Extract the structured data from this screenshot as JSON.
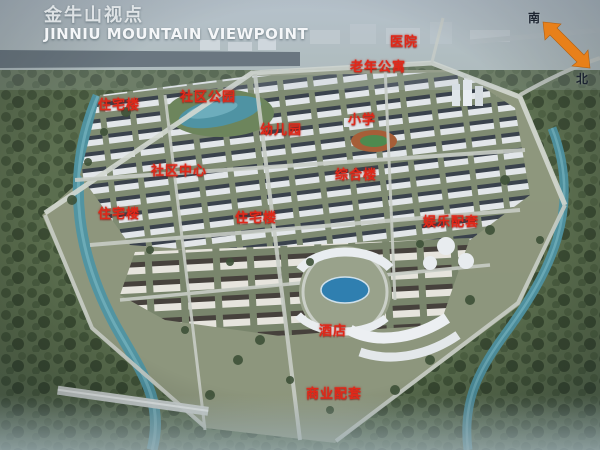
{
  "header": {
    "title_cn": "金牛山视点",
    "title_en": "JINNIU MOUNTAIN VIEWPOINT"
  },
  "compass": {
    "south": "南",
    "north": "北",
    "arrow_color": "#e8801a"
  },
  "labels": [
    {
      "text": "医院",
      "x": 390,
      "y": 31
    },
    {
      "text": "老年公寓",
      "x": 350,
      "y": 56
    },
    {
      "text": "社区公园",
      "x": 180,
      "y": 86
    },
    {
      "text": "住宅楼",
      "x": 98,
      "y": 94
    },
    {
      "text": "小学",
      "x": 348,
      "y": 109
    },
    {
      "text": "幼儿园",
      "x": 260,
      "y": 119
    },
    {
      "text": "社区中心",
      "x": 151,
      "y": 160
    },
    {
      "text": "综合楼",
      "x": 335,
      "y": 164
    },
    {
      "text": "住宅楼",
      "x": 98,
      "y": 203
    },
    {
      "text": "住宅楼",
      "x": 235,
      "y": 207
    },
    {
      "text": "娱乐配套",
      "x": 423,
      "y": 211
    },
    {
      "text": "酒店",
      "x": 319,
      "y": 320
    },
    {
      "text": "商业配套",
      "x": 306,
      "y": 383
    }
  ],
  "colors": {
    "label_red": "#e02819",
    "title_white": "#f4f6f8",
    "water_teal": "#4f93a3",
    "compass_orange": "#e8801a"
  }
}
